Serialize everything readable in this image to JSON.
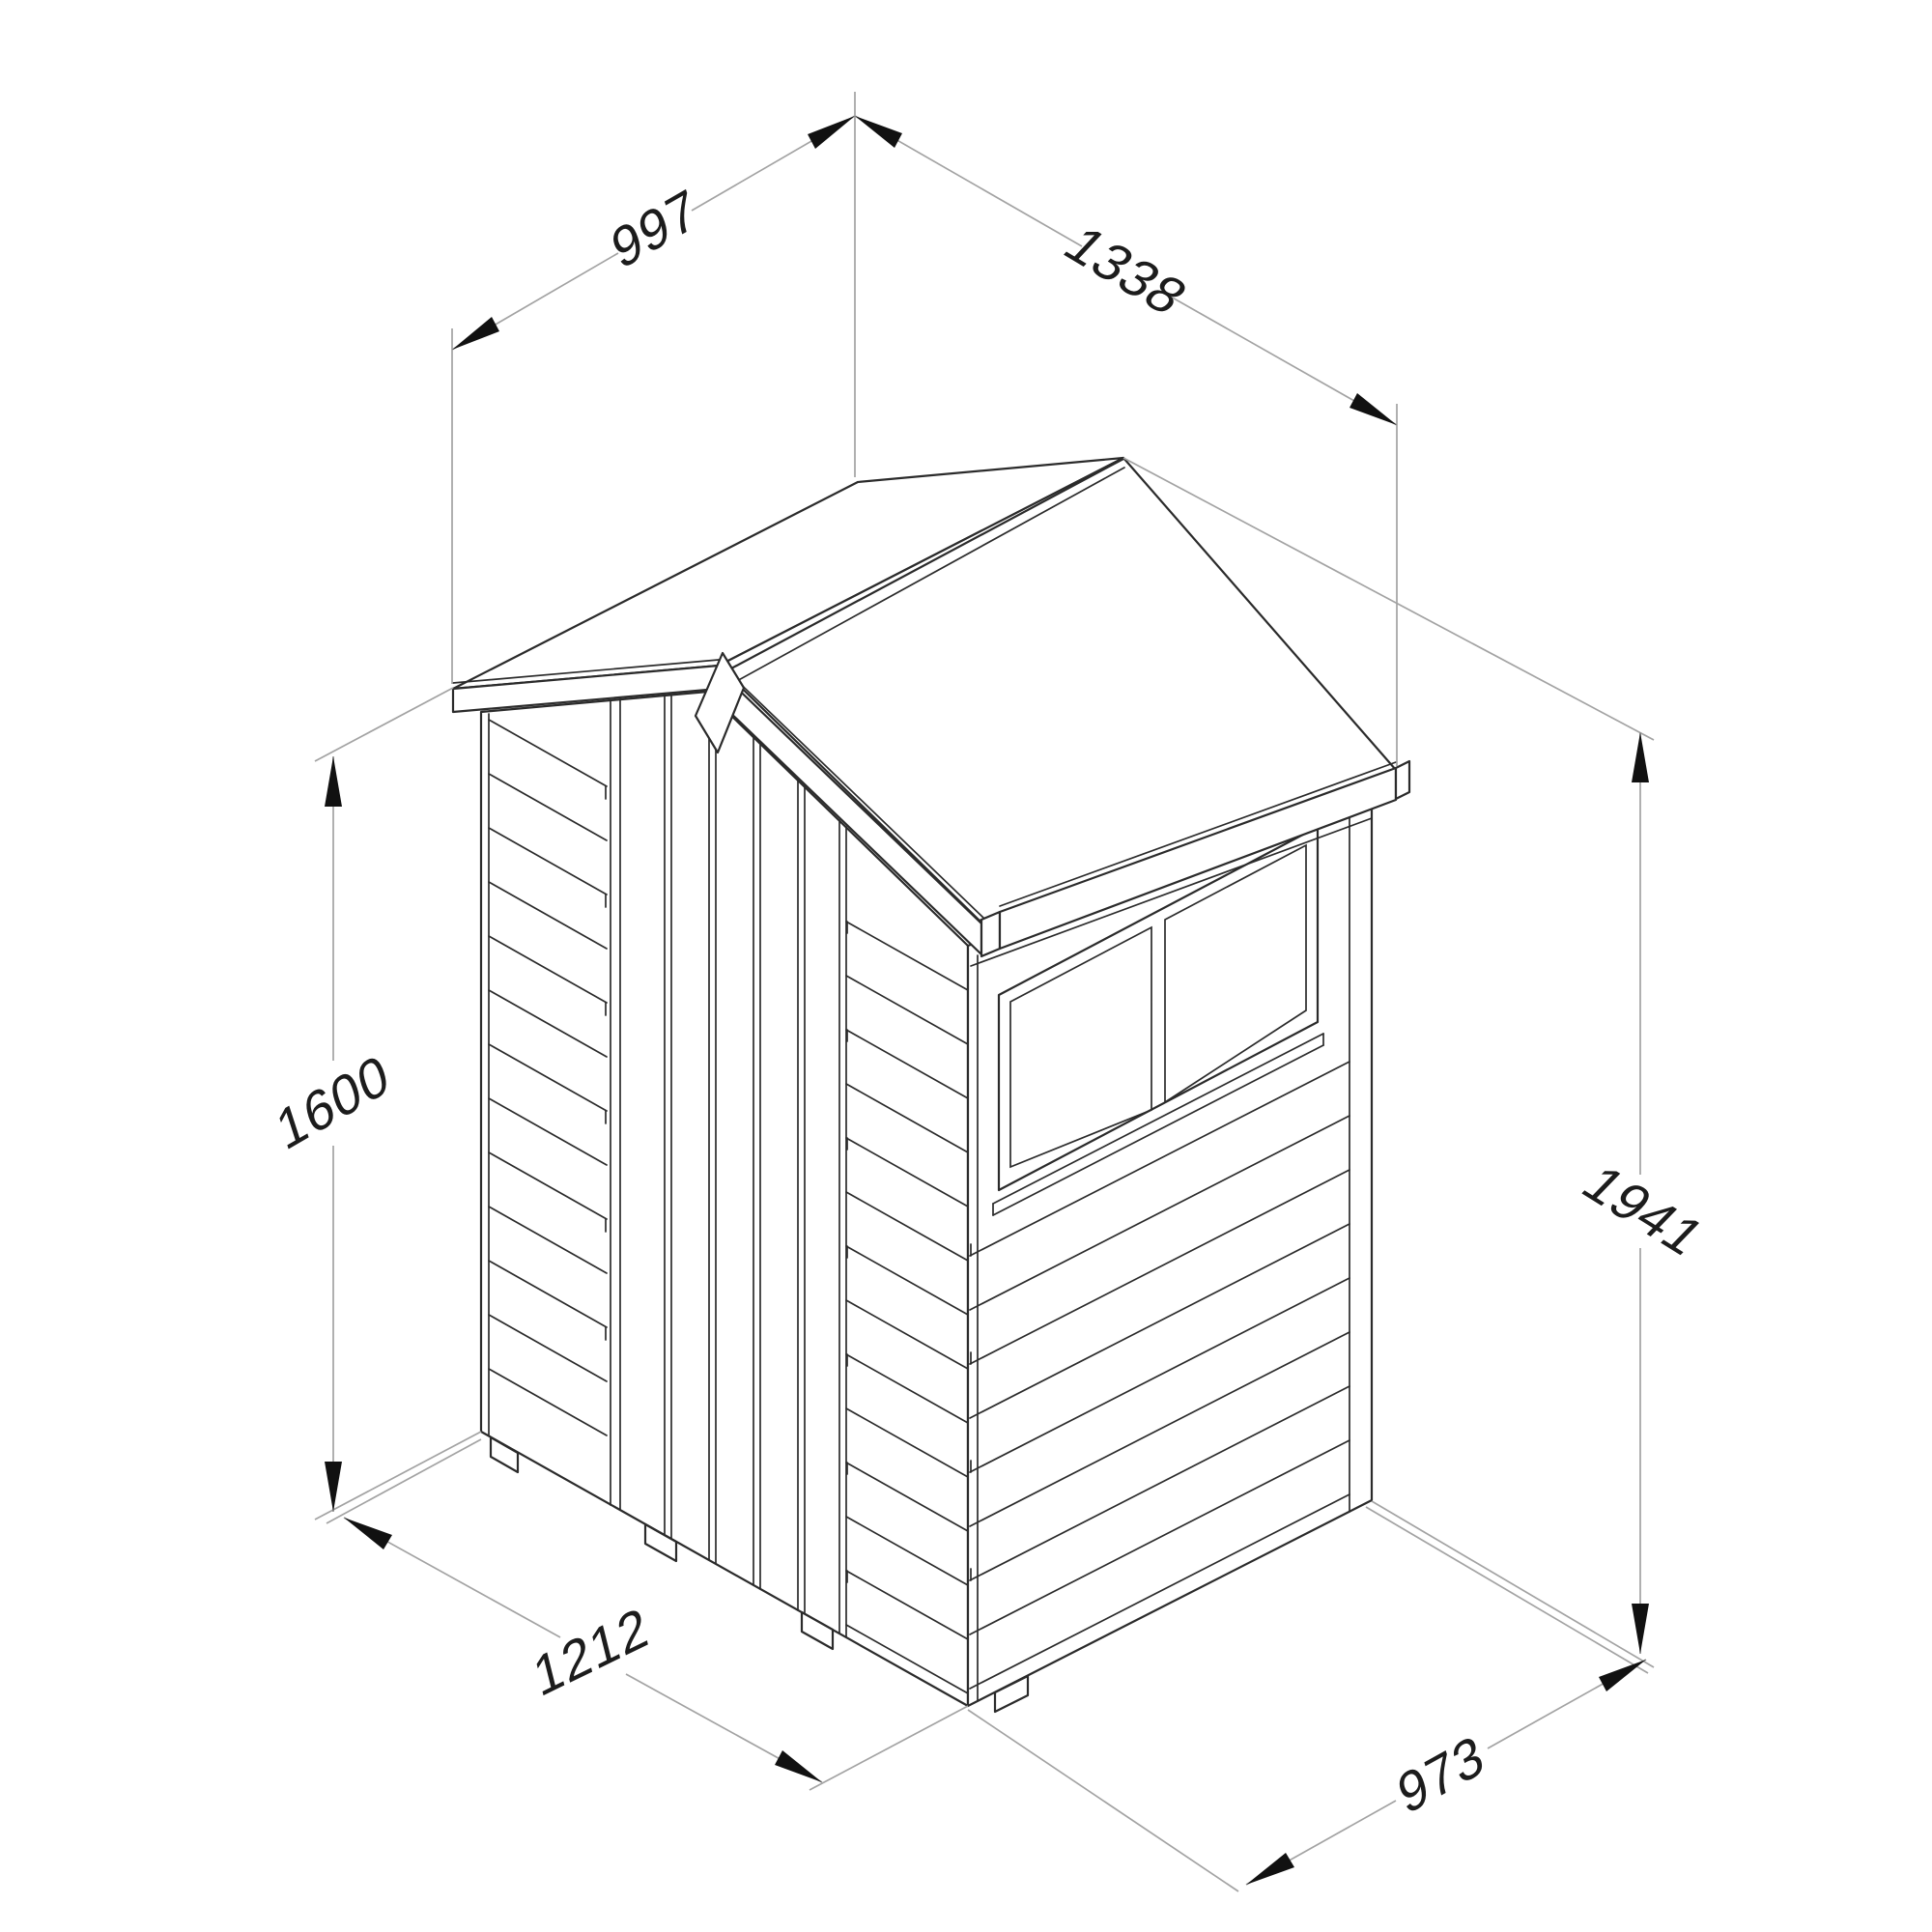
{
  "drawing": {
    "kind": "isometric dimension line drawing of an apex-roof garden shed",
    "dims": {
      "top_left": {
        "value": "997"
      },
      "top_right": {
        "value": "1338"
      },
      "left_height": {
        "value": "1600"
      },
      "right_height": {
        "value": "1941"
      },
      "bottom_front": {
        "value": "1212"
      },
      "bottom_side": {
        "value": "973"
      }
    },
    "colors": {
      "background": "#ffffff",
      "ink": "#2b2b2b",
      "dimension_lines": "#a3a3a3",
      "dimension_text": "#1c1c1c"
    }
  }
}
